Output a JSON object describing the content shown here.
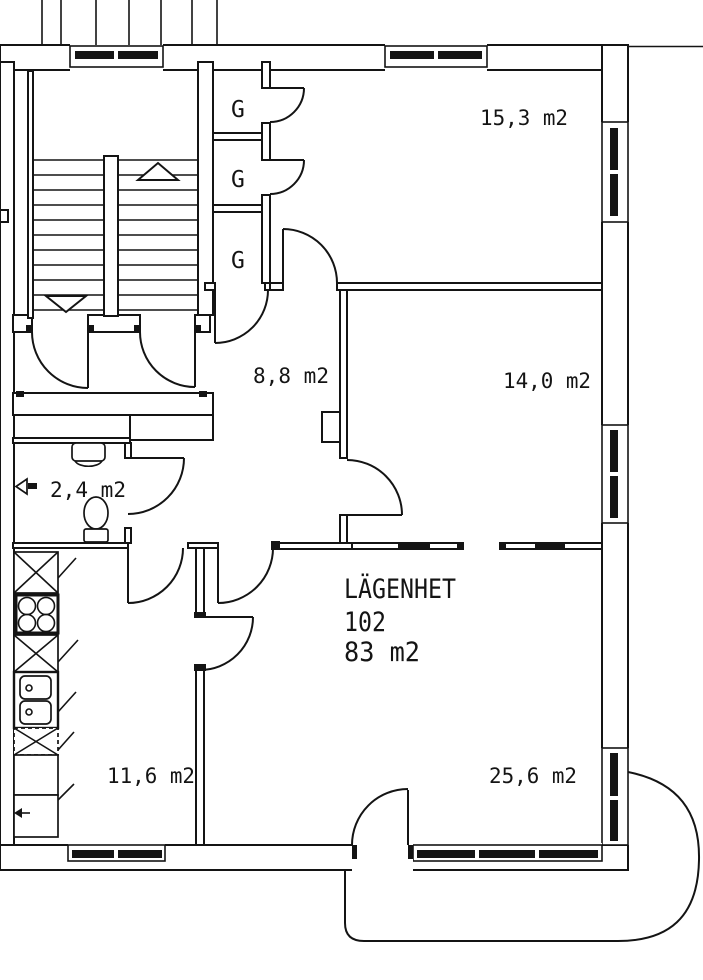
{
  "plan": {
    "title_block": {
      "title": "LÄGENHET",
      "number": "102",
      "area": "83 m2"
    },
    "rooms": [
      {
        "id": "room-top-right",
        "area_label": "15,3 m2"
      },
      {
        "id": "room-mid-right",
        "area_label": "14,0 m2"
      },
      {
        "id": "hall",
        "area_label": "8,8 m2"
      },
      {
        "id": "wc",
        "area_label": "2,4 m2"
      },
      {
        "id": "kitchen",
        "area_label": "11,6 m2"
      },
      {
        "id": "living-room",
        "area_label": "25,6 m2"
      }
    ],
    "closets": [
      {
        "label": "G"
      },
      {
        "label": "G"
      },
      {
        "label": "G"
      }
    ],
    "colors": {
      "line": "#141414",
      "background": "#ffffff"
    }
  }
}
